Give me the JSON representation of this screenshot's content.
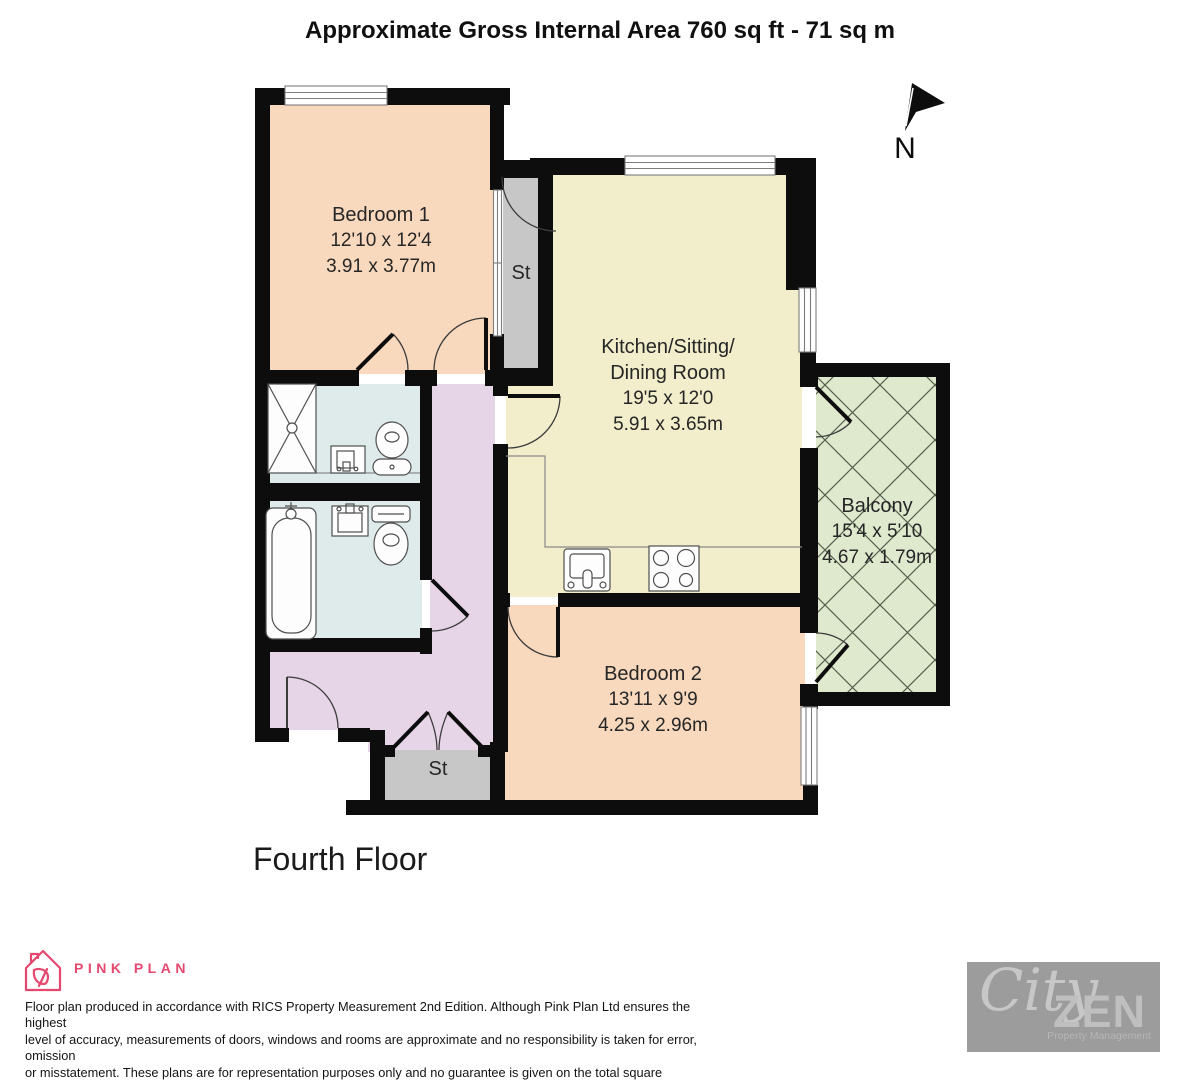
{
  "title": "Approximate Gross Internal Area 760 sq ft - 71 sq m",
  "compass": {
    "label": "N"
  },
  "rooms": {
    "bedroom1": {
      "name": "Bedroom 1",
      "imperial": "12'10 x 12'4",
      "metric": "3.91 x 3.77m"
    },
    "kitchen": {
      "name_line1": "Kitchen/Sitting/",
      "name_line2": "Dining Room",
      "imperial": "19'5 x 12'0",
      "metric": "5.91 x 3.65m"
    },
    "balcony": {
      "name": "Balcony",
      "imperial": "15'4 x 5'10",
      "metric": "4.67 x 1.79m"
    },
    "bedroom2": {
      "name": "Bedroom 2",
      "imperial": "13'11 x 9'9",
      "metric": "4.25 x 2.96m"
    },
    "storage_top": {
      "name": "St"
    },
    "storage_bottom": {
      "name": "St"
    }
  },
  "floor_label": "Fourth Floor",
  "footer": {
    "brand": "PINK PLAN",
    "disclaimer": "Floor plan produced in accordance with RICS Property Measurement 2nd Edition. Although Pink Plan Ltd ensures the highest\nlevel of accuracy, measurements of doors, windows and rooms are approximate and no responsibility is taken for error, omission\nor misstatement. These plans are for representation purposes only and no guarantee is given on the total square footage of the\nproperty within this plan. The figure icon is for initial guidance only and should not be relied on as a basis of valuation.",
    "agency": {
      "script": "City",
      "bold": "ZEN",
      "tagline": "Property Management"
    }
  },
  "colors": {
    "wall": "#0D0D0D",
    "bedroom": "#F8D9BE",
    "kitchen": "#F2EDCB",
    "bathroom": "#DFEBEA",
    "hallway": "#E5D5E6",
    "storage": "#C7C7C7",
    "balcony": "#DFE9CE",
    "balcony_hatch": "#55604F",
    "brand_pink": "#E5486E",
    "agency_gray": "#9C9C9C"
  }
}
